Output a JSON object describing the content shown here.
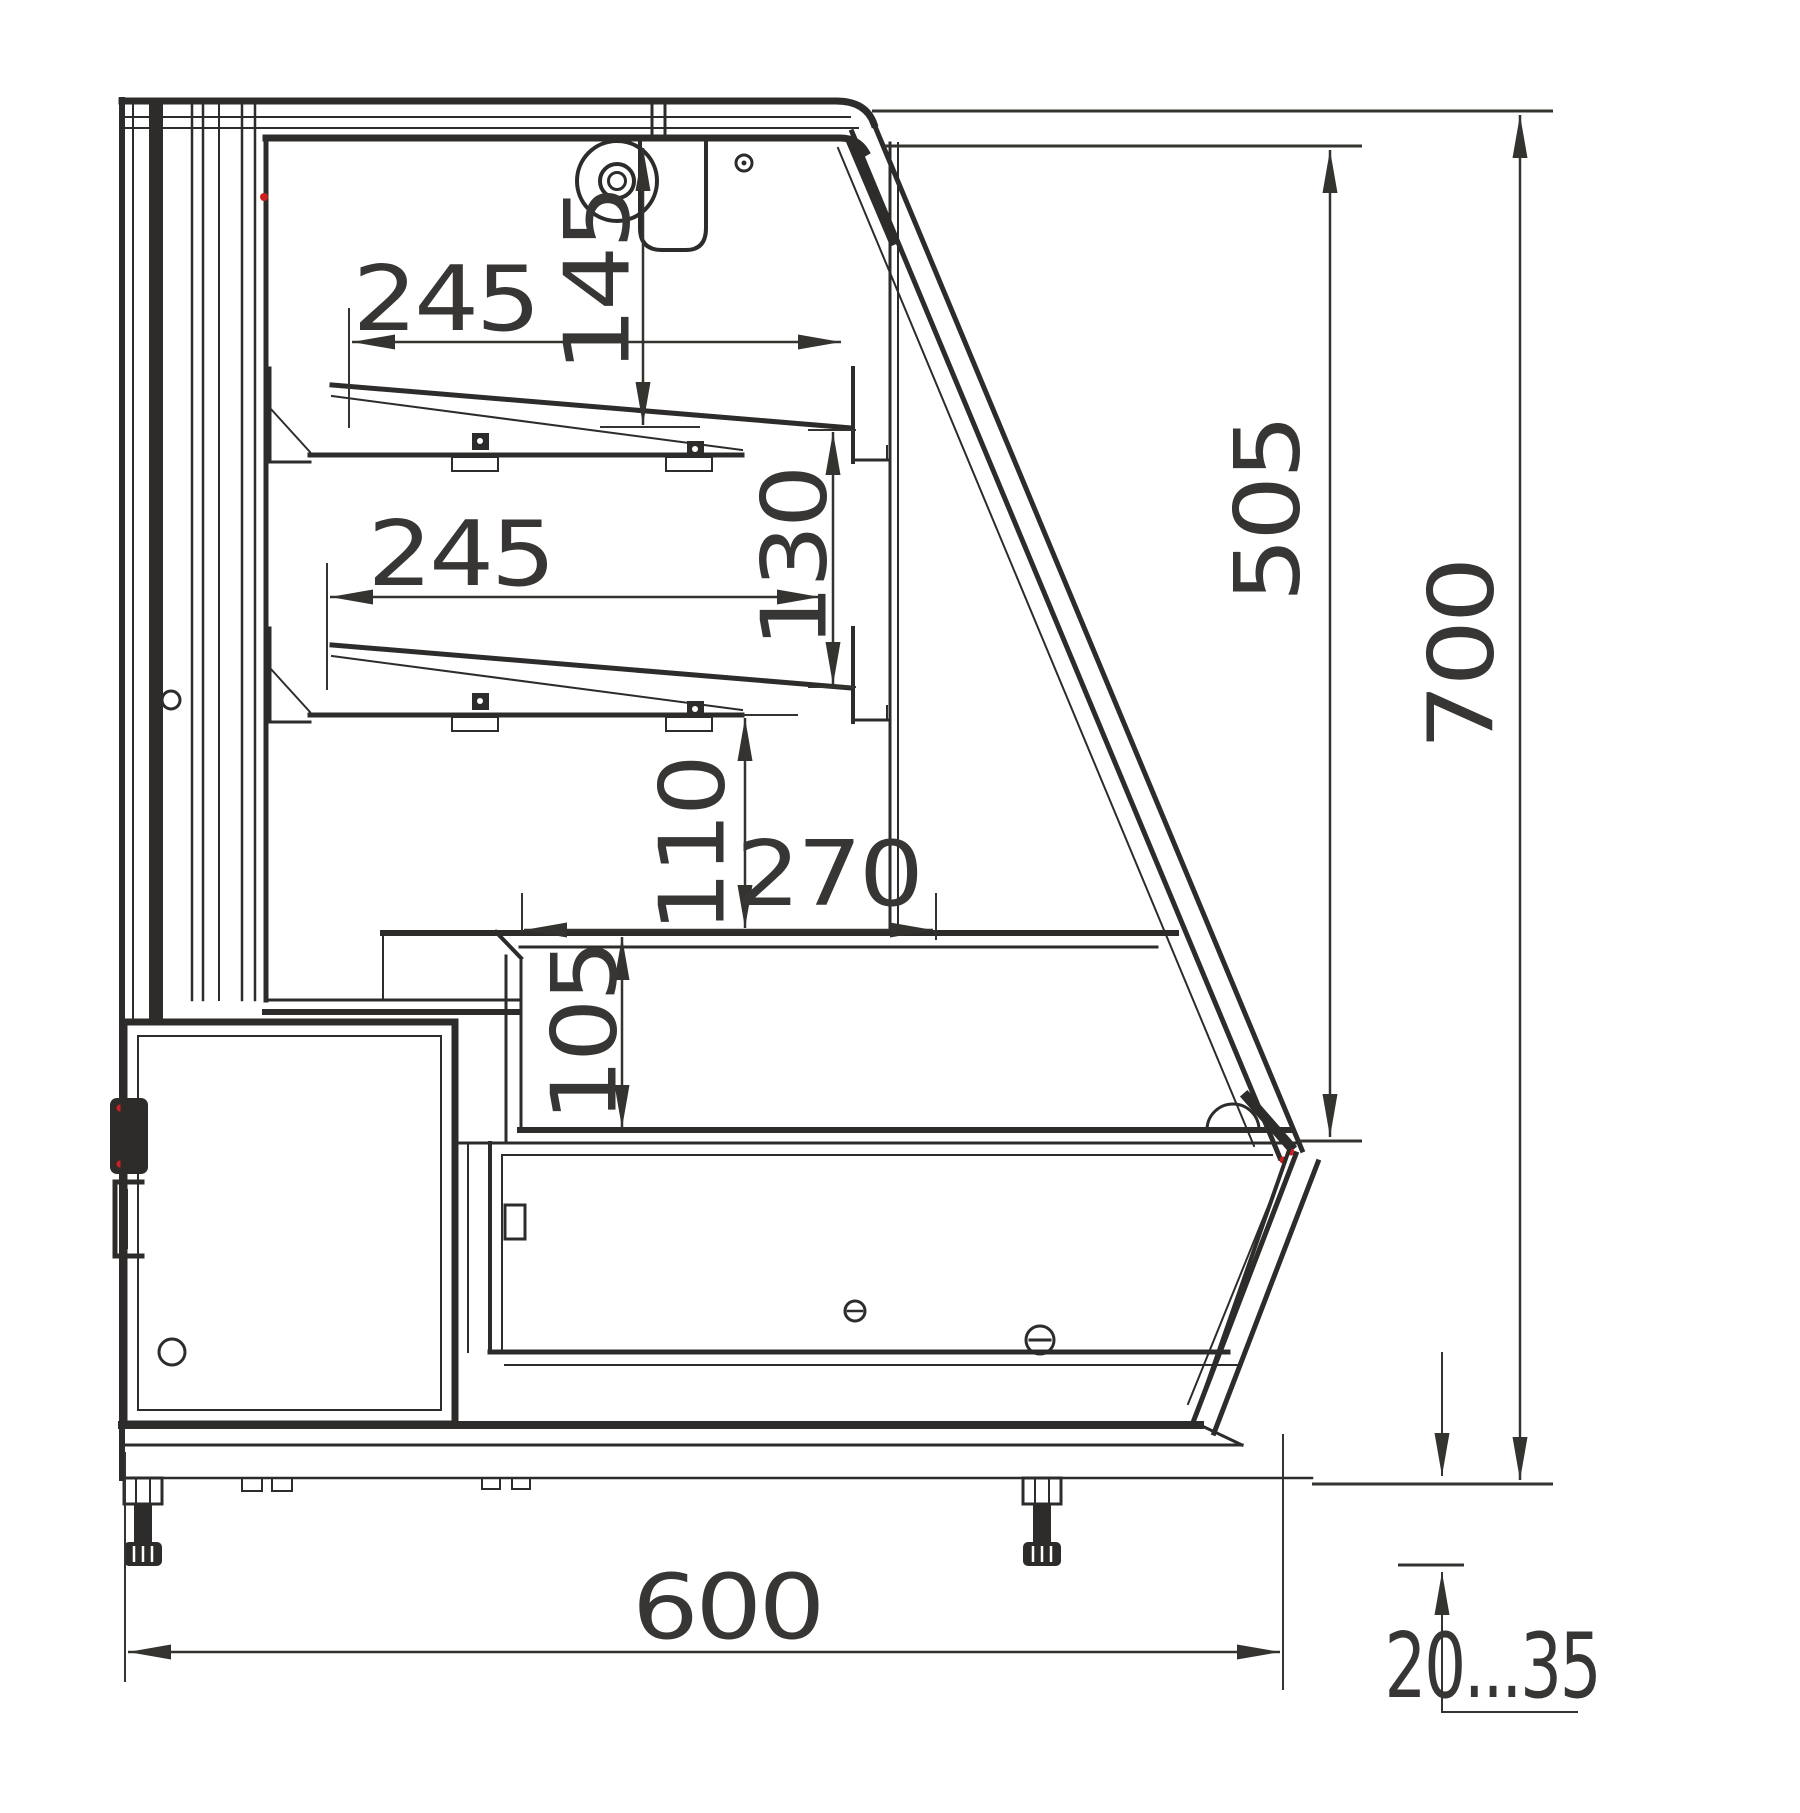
{
  "drawing": {
    "type": "technical-drawing",
    "view": "side-cross-section",
    "subject": "refrigerated display counter",
    "units": "mm"
  },
  "dims": {
    "top_shelf_depth": "245",
    "top_shelf_drop": "145",
    "mid_shelf_depth": "245",
    "shelf_spacing": "130",
    "mid_shelf_to_deck": "110",
    "well_opening": "270",
    "well_height": "105",
    "glass_opening_height": "505",
    "overall_height": "700",
    "overall_depth": "600",
    "foot_adjust_range": "20...35"
  },
  "colors": {
    "line": "#2e2c2b",
    "text": "#383634",
    "accent_red": "#cc1f1f",
    "background": "#ffffff"
  }
}
